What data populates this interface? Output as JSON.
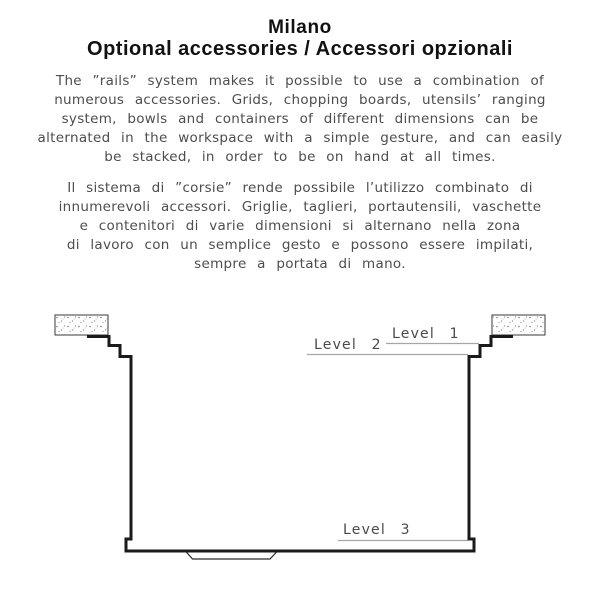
{
  "header": {
    "title": "Milano",
    "subtitle": "Optional accessories / Accessori opzionali"
  },
  "body": {
    "english_lines": [
      "The ”rails” system makes it possible to use a combination of",
      "numerous accessories. Grids, chopping boards, utensils’ ranging",
      "system, bowls and containers of different dimensions can be",
      "alternated in the workspace with a simple gesture, and can easily",
      "be stacked, in order to be on hand at all times."
    ],
    "italian_lines": [
      "Il sistema di ”corsie” rende possibile l’utilizzo combinato di",
      "innumerevoli accessori. Griglie, taglieri, portautensili, vaschette",
      "e contenitori di varie dimensioni si alternano nella zona",
      "di lavoro con un semplice gesto e possono essere impilati,",
      "sempre a portata di mano."
    ]
  },
  "diagram": {
    "type": "sink-cross-section",
    "labels": {
      "level1": "Level 1",
      "level2": "Level 2",
      "level3": "Level 3"
    },
    "colors": {
      "profile_line": "#1a1a1a",
      "thin_line": "#2a2a2a",
      "leader_line": "#a6a6a6",
      "countertop_edge": "#3a3a3a",
      "label_text": "#4a4a4a",
      "body_text": "#4d4d4d",
      "title_text": "#111111",
      "background": "#ffffff"
    }
  }
}
